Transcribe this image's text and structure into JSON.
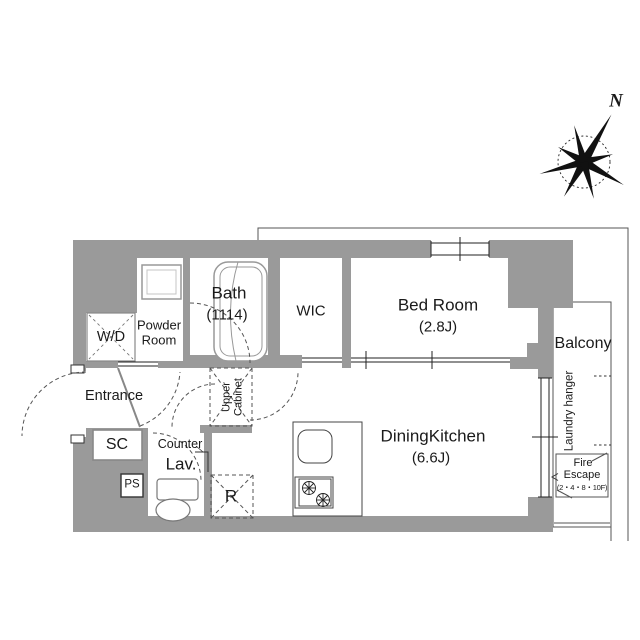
{
  "compass": {
    "label": "N"
  },
  "rooms": {
    "bath": {
      "name": "Bath",
      "size": "(1114)"
    },
    "wic": {
      "name": "WIC"
    },
    "bedroom": {
      "name": "Bed Room",
      "size": "(2.8J)"
    },
    "dining_kitchen": {
      "name": "DiningKitchen",
      "size": "(6.6J)"
    },
    "balcony": {
      "name": "Balcony"
    },
    "powder_room": {
      "name": "Powder Room"
    },
    "entrance": {
      "name": "Entrance"
    },
    "washer_dryer": {
      "name": "W/D"
    },
    "shoe_cabinet": {
      "name": "SC"
    },
    "pipe_space": {
      "name": "PS"
    },
    "lavatory": {
      "name": "Lav."
    },
    "counter": {
      "name": "Counter"
    },
    "refrigerator": {
      "name": "R"
    },
    "upper_cabinet": {
      "name": "Upper Cabinet"
    }
  },
  "balcony_features": {
    "laundry_hanger": "Laundry hanger"
  },
  "fire_escape": {
    "line1": "Fire",
    "line2": "Escape",
    "line3": "(2・4・8・10F)"
  },
  "colors": {
    "wall": "#9a9a9a",
    "line": "#555555",
    "text": "#1a1a1a"
  }
}
